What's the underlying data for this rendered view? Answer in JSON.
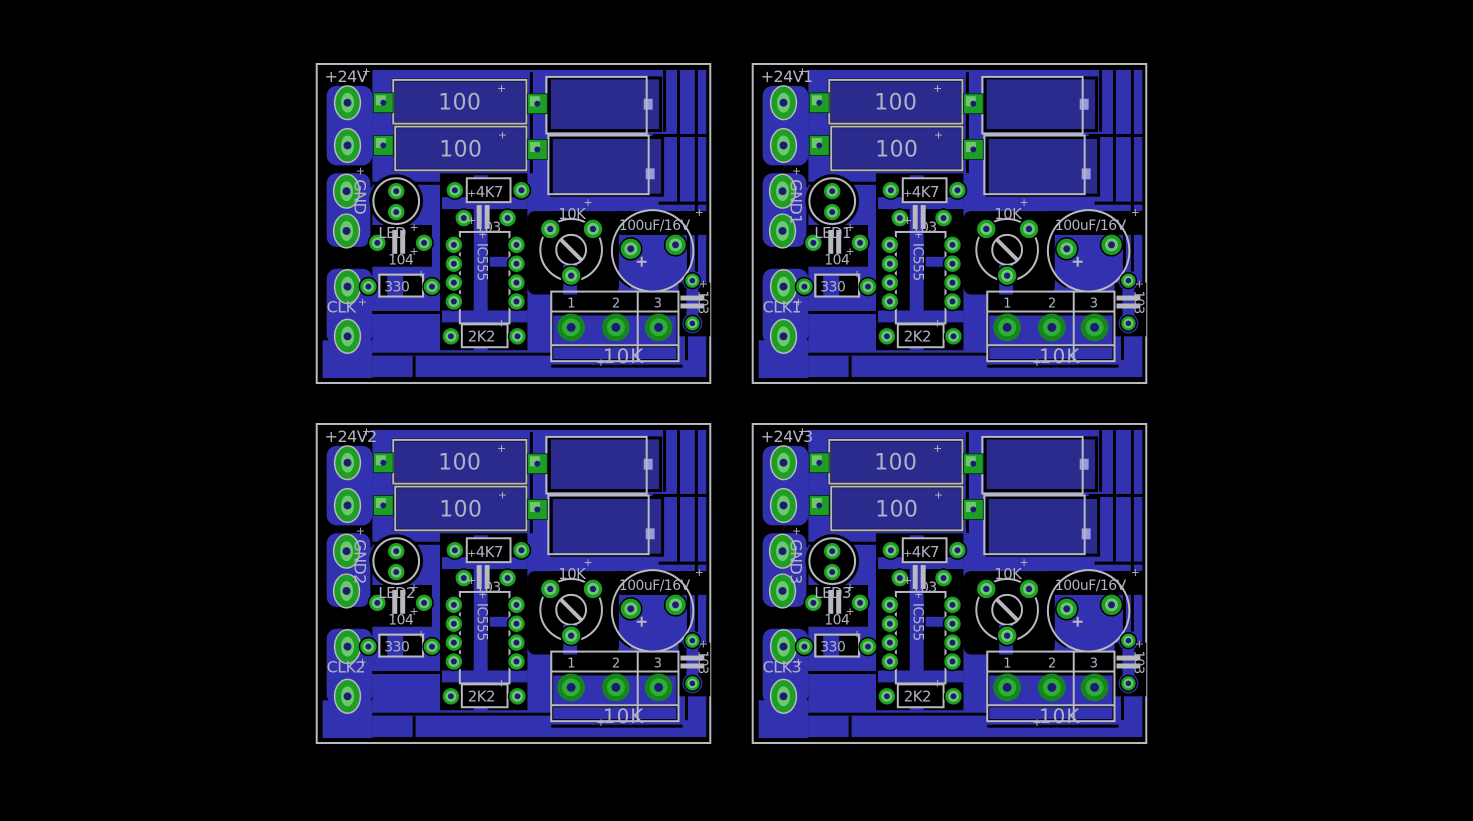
{
  "page": {
    "background": "#000000",
    "description": "PCB board layout, four copies in a 2x2 grid"
  },
  "colors": {
    "pour_blue": "#3232b0",
    "body_navy": "#2b2b8e",
    "silkscreen_gray": "#b9b9c0",
    "text_gray": "#b2b2c4",
    "pad_green": "#1f9e26",
    "pad_core_green": "#6fc86f",
    "drill_navy": "#1c1c78",
    "via_mark_periwinkle": "#9a9ade"
  },
  "icons": {
    "origin_cross": "+",
    "polarity_plus": "+"
  },
  "boards": [
    {
      "power_label": "+24V",
      "gnd_label": "GND",
      "led_label": "LED",
      "clk_label": "CLK"
    },
    {
      "power_label": "+24V1",
      "gnd_label": "GND1",
      "led_label": "LED1",
      "clk_label": "CLK1"
    },
    {
      "power_label": "+24V2",
      "gnd_label": "GND2",
      "led_label": "LED2",
      "clk_label": "CLK2"
    },
    {
      "power_label": "+24V3",
      "gnd_label": "GND3",
      "led_label": "LED3",
      "clk_label": "CLK3"
    }
  ],
  "shared": {
    "r_100_top": "100",
    "r_100_bottom": "100",
    "r_4k7": "4K7",
    "c_103_ic": "103",
    "c_104": "104",
    "r_330": "330",
    "ic_555": "IC555",
    "r_2k2": "2K2",
    "trimmer_10k": "10K",
    "cap_electrolytic": "100uF/16V",
    "c_103_edge": "103",
    "pot_10k": "10K",
    "pot_pin_1": "1",
    "pot_pin_2": "2",
    "pot_pin_3": "3"
  }
}
